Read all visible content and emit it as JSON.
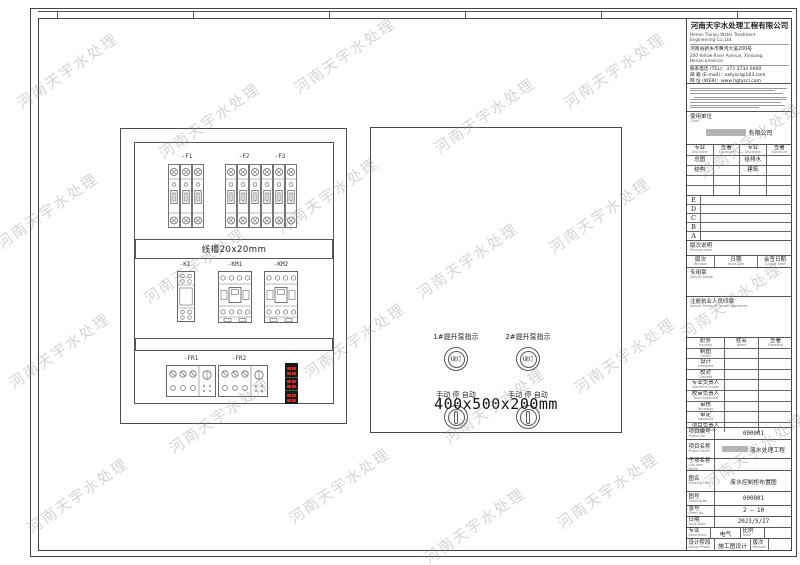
{
  "watermark": {
    "text": "河南天宇水处理"
  },
  "cabinet": {
    "breaker_labels": [
      "-F1",
      "-F2",
      "-F3"
    ],
    "duct_label": "线槽20x20mm",
    "component_labels": [
      "-K1",
      "-KM1",
      "-KM2"
    ],
    "relay_labels": [
      "-FR1",
      "-FR2"
    ]
  },
  "door": {
    "light1_label": "1#提升泵指示",
    "light2_label": "2#提升泵指示",
    "light_text": "绿灯",
    "switch_label": "手动 停 自动",
    "dimension": "400x500x200mm"
  },
  "titleblock": {
    "company_cn": "河南天宇水处理工程有限公司",
    "company_en1": "Henan Tianyu Water Treatment",
    "company_en2": "Engineering Co.,Ltd.",
    "address_cn": "河南省新乡市黄河大道200号",
    "address_en1": "200 Yellow River Avenue, Xinxiang,",
    "address_en2": "Henan province",
    "tel": "联系电话 (TEL)：373 3733 0000",
    "email": "邮 箱 (E-mail)：xxtyscl@163.com",
    "web": "网 址 (WEB)：www.hgtyscl.com",
    "client": {
      "label": "使用单位",
      "label_en": "Client",
      "value_suffix": "有限公司"
    },
    "sign_table": {
      "headers": [
        {
          "cn": "专业",
          "en": "Discipline"
        },
        {
          "cn": "签署",
          "en": "Signature"
        },
        {
          "cn": "专业",
          "en": "Discipline"
        },
        {
          "cn": "签署",
          "en": "Signature"
        }
      ],
      "rows": [
        [
          "总图",
          "",
          "给排水",
          ""
        ],
        [
          "结构",
          "",
          "建筑",
          ""
        ],
        [
          "",
          "",
          "",
          ""
        ],
        [
          "",
          "",
          "",
          ""
        ]
      ]
    },
    "revision_letters": [
      "E",
      "D",
      "C",
      "B",
      "A"
    ],
    "revision_note": {
      "cn": "版次说明",
      "en": "Revision Note"
    },
    "revision_cols": [
      {
        "cn": "版次",
        "en": "Revision"
      },
      {
        "cn": "日期",
        "en": "Issue Date"
      },
      {
        "cn": "会签日期",
        "en": "Consult Date"
      }
    ],
    "stamp": {
      "cn": "专用章",
      "en": "Special Stamp"
    },
    "reg_stamp": {
      "cn": "注册执业人员印章",
      "en": "Special Stamp Of Person Registered"
    },
    "staff_table": {
      "headers": [
        {
          "cn": "职务",
          "en": "Function"
        },
        {
          "cn": "姓名",
          "en": "Name"
        },
        {
          "cn": "签署",
          "en": "Signature"
        }
      ],
      "rows": [
        {
          "cn": "制图",
          "en": "Drawn"
        },
        {
          "cn": "设计",
          "en": "Designed"
        },
        {
          "cn": "校对",
          "en": "Checked"
        },
        {
          "cn": "专业负责人",
          "en": "Specialist Leader"
        },
        {
          "cn": "校审负责人",
          "en": "Team Approved"
        },
        {
          "cn": "审核",
          "en": "Reviewed"
        },
        {
          "cn": "审定",
          "en": "Approved"
        },
        {
          "cn": "项目负责人",
          "en": "Project Leader"
        }
      ]
    },
    "info": {
      "project_no": {
        "cn": "项目编号",
        "en": "Project No.",
        "value": "000001"
      },
      "project_name": {
        "cn": "项目名称",
        "en": "Project Name",
        "value": "废水处理工程"
      },
      "subitem": {
        "cn": "子项名称",
        "en": "Sub-item Name",
        "value": ""
      },
      "drawing_title": {
        "cn": "图名",
        "en": "Drawing Title",
        "value": "废水控制柜布置图"
      },
      "drawing_no": {
        "cn": "图号",
        "en": "Drawing No.",
        "value": "000001"
      },
      "sheet_no": {
        "cn": "张号",
        "en": "Sheet No.",
        "value": "2 — 10"
      },
      "date": {
        "cn": "日期",
        "en": "Issue Date",
        "value": "2023/5/27"
      },
      "discipline": {
        "cn": "专业",
        "en": "Description",
        "value": "电气"
      },
      "scale": {
        "cn": "比例",
        "en": "Scale",
        "value": ""
      },
      "phase": {
        "cn": "设计阶段",
        "en": "Design Phase",
        "value": "施工图设计"
      },
      "revision": {
        "cn": "版次",
        "en": "Revision",
        "value": ""
      }
    }
  }
}
